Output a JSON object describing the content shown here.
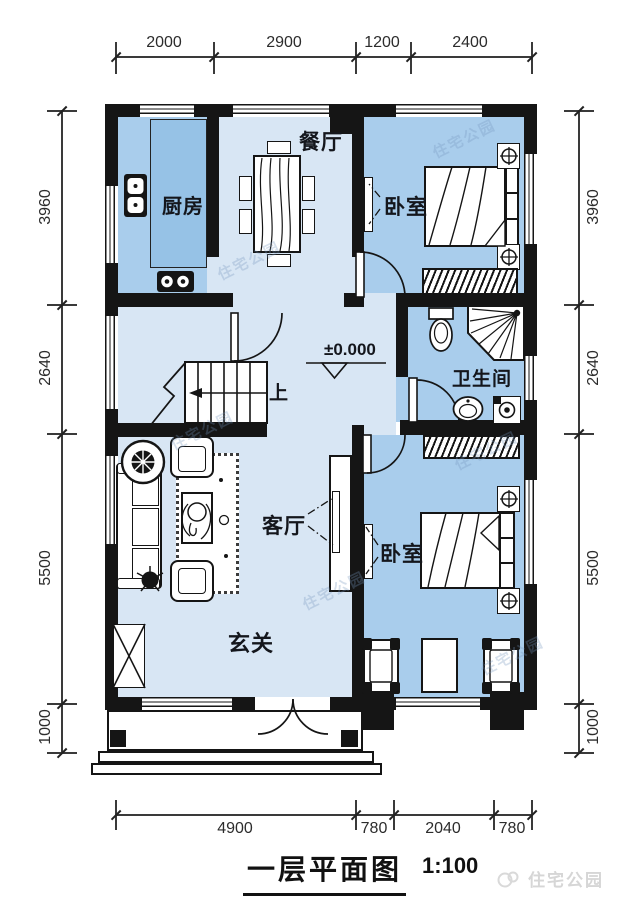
{
  "plan": {
    "title": "一层平面图",
    "scale": "1:100",
    "elevation_marker": "±0.000",
    "stair_up_label": "上",
    "brand_watermark": "住宅公园"
  },
  "rooms": {
    "dining": "餐厅",
    "kitchen": "厨房",
    "bedroom_top": "卧室",
    "bathroom": "卫生间",
    "living": "客厅",
    "bedroom_bottom": "卧室",
    "foyer": "玄关"
  },
  "dimensions": {
    "top": [
      "2000",
      "2900",
      "1200",
      "2400"
    ],
    "left": [
      "3960",
      "2640",
      "5500",
      "1000"
    ],
    "right": [
      "3960",
      "2640",
      "5500",
      "1000"
    ],
    "bottom": [
      "4900",
      "780",
      "2040",
      "780"
    ]
  },
  "colors": {
    "wall": "#151515",
    "floor_light": "#d8e6f4",
    "floor_medium": "#a9cdec",
    "counter": "#96c2e6"
  }
}
